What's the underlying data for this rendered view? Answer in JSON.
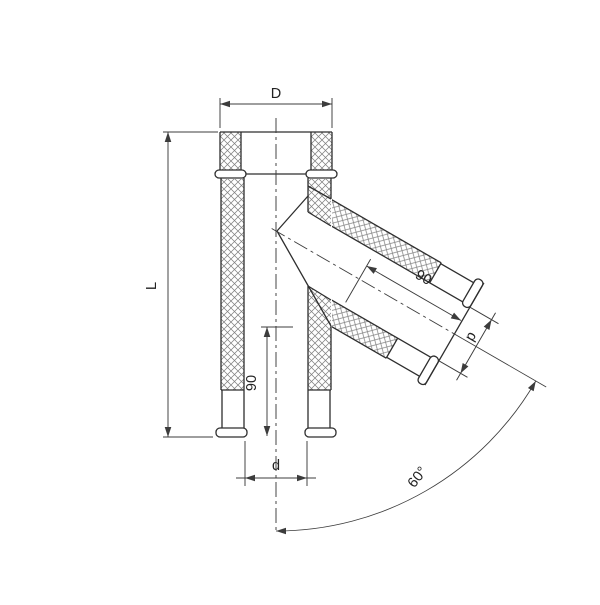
{
  "drawing": {
    "labels": {
      "outer_diameter": "D",
      "length": "L",
      "stub_length_vertical": "90",
      "inner_diameter_bottom": "d",
      "stub_length_branch": "90",
      "inner_diameter_branch": "d",
      "branch_angle": "60°"
    },
    "colors": {
      "background": "#ffffff",
      "line": "#2e2e2e",
      "dim": "#3c3c3c",
      "hatch": "#808080"
    }
  }
}
